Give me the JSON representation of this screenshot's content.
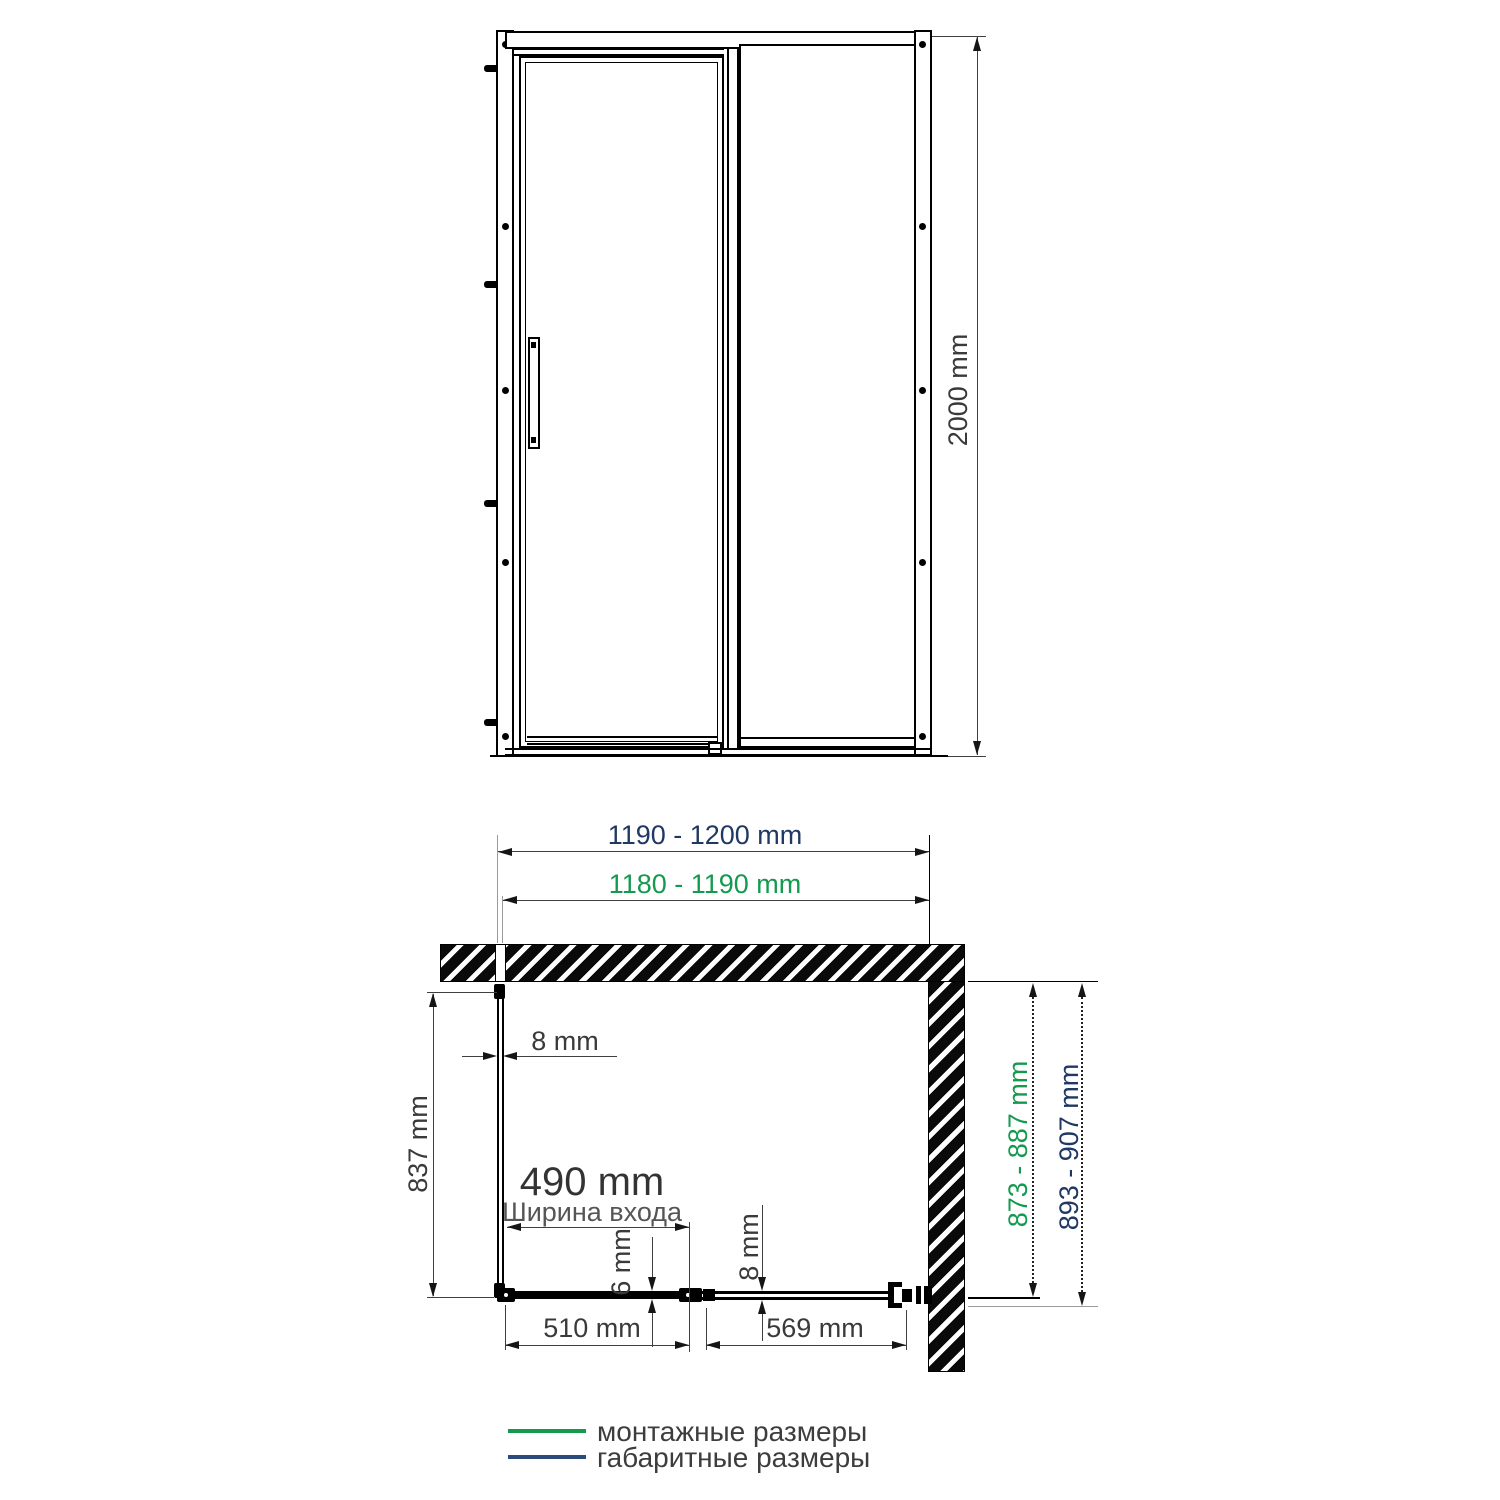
{
  "front_view": {
    "height": "2000 mm"
  },
  "plan_view": {
    "overall_width": "1190 - 1200 mm",
    "mounting_width": "1180 - 1190 mm",
    "side_glass_thickness": "8 mm",
    "side_panel_depth": "837 mm",
    "entrance_width": "490 mm",
    "entrance_width_caption": "Ширина входа",
    "fixed_glass_thickness": "6 mm",
    "door_glass_thickness": "8 mm",
    "fixed_panel_width": "510 mm",
    "door_panel_width": "569 mm",
    "mounting_depth": "873 - 887 mm",
    "overall_depth": "893 - 907 mm"
  },
  "legend": {
    "items": [
      {
        "label": "монтажные размеры",
        "color": "#159a4d"
      },
      {
        "label": "габаритные размеры",
        "color": "#2a4b7c"
      }
    ]
  },
  "colors": {
    "mounting_dimension_green": "#149a4f",
    "overall_dimension_navy": "#1f3864",
    "dimension_text_gray": "#3a3a3a",
    "drawing_line_black": "#000000"
  }
}
